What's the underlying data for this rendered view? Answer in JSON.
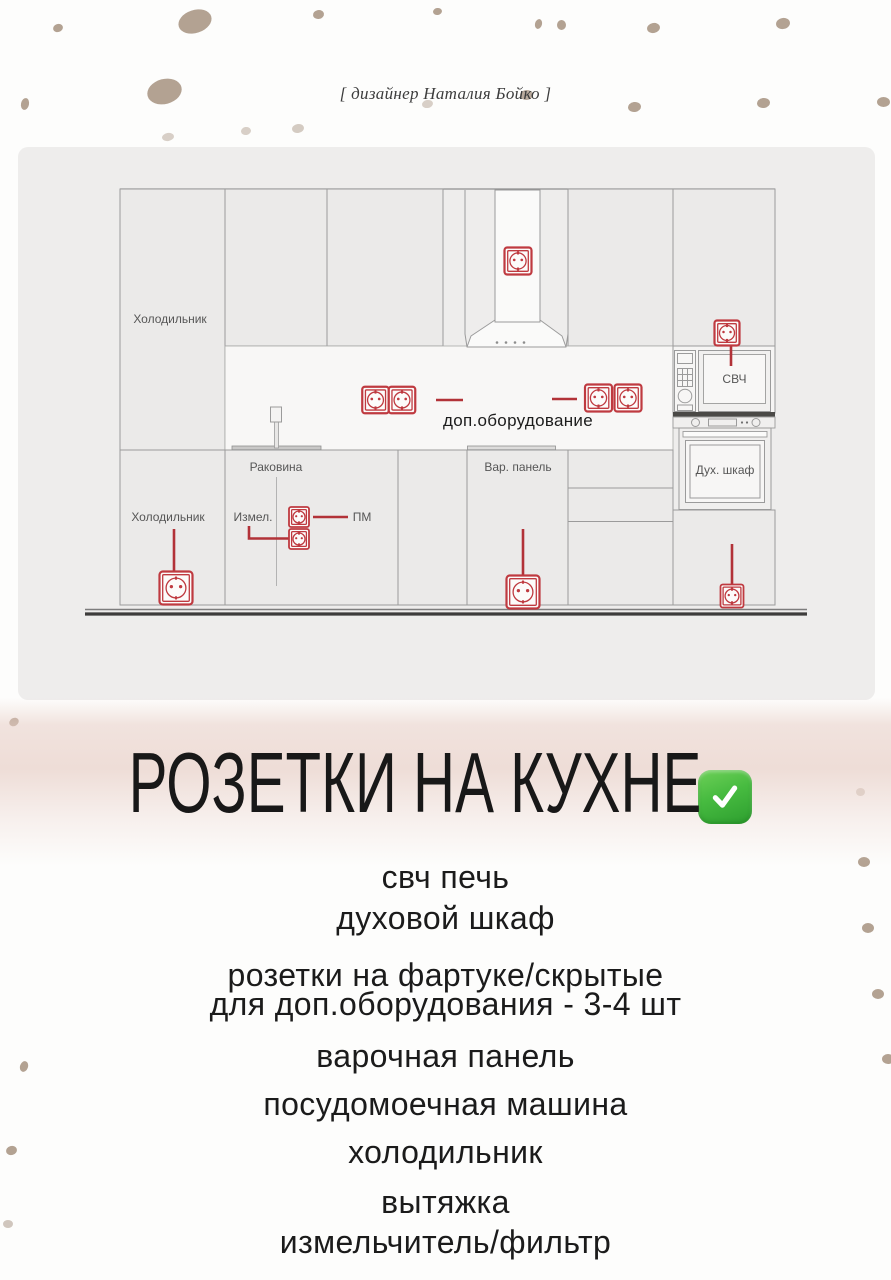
{
  "header": {
    "credit": "[ дизайнер Наталия Бойко ]",
    "title": "РОЗЕТКИ НА КУХНЕ",
    "check_icon": "green-check"
  },
  "diagram": {
    "labels": {
      "fridge_upper": "Холодильник",
      "fridge_lower": "Холодильник",
      "sink": "Раковина",
      "grinder_short": "Измел.",
      "dishwasher_short": "ПМ",
      "cooktop_short": "Вар. панель",
      "microwave_short": "СВЧ",
      "oven_short": "Дух. шкаф",
      "extra_equipment": "доп.оборудование"
    },
    "outlet_symbol": "schuko-socket-icon",
    "colors": {
      "outlet_red": "#bf3a40",
      "line_red": "#b23238",
      "panel_bg": "#eeedec",
      "dot_beige": "#b3a292",
      "check_green": "#3fae3c",
      "title_glow_pink": "#e7cdc5"
    }
  },
  "list": {
    "items": [
      {
        "text": "свч печь"
      },
      {
        "text": "духовой шкаф"
      },
      {
        "text": "розетки на фартуке/скрытые"
      },
      {
        "text": "для доп.оборудования - 3-4 шт"
      },
      {
        "text": "варочная панель"
      },
      {
        "text": "посудомоечная машина"
      },
      {
        "text": "холодильник"
      },
      {
        "text": "вытяжка"
      },
      {
        "text": "измельчитель/фильтр"
      }
    ]
  }
}
